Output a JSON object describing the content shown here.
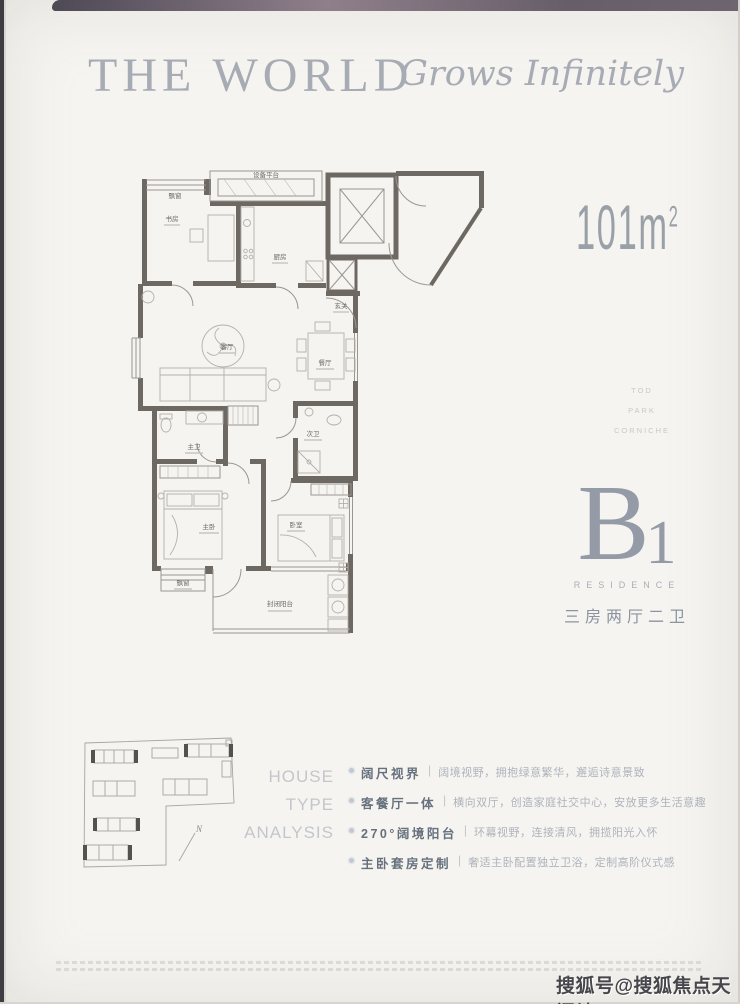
{
  "header": {
    "title_main": "THE WORLD",
    "title_script": "Grows Infinitely"
  },
  "right_panel": {
    "area_value": "101m",
    "area_sup": "2",
    "keywords": [
      "TOD",
      "PARK",
      "CORNICHE"
    ],
    "unit_letter": "B",
    "unit_number": "1",
    "residence_label": "RESIDENCE",
    "unit_type": "三房两厅二卫"
  },
  "floorplan": {
    "rooms": {
      "equipment": "设备平台",
      "bay_top": "飘窗",
      "study": "书房",
      "kitchen": "厨房",
      "foyer": "玄关",
      "dining": "餐厅",
      "living": "客厅",
      "master_bath": "主卫",
      "second_bath": "次卫",
      "master_bedroom": "主卧",
      "bedroom": "卧室",
      "bay_bottom": "飘窗",
      "balcony": "封闭阳台"
    }
  },
  "keyplan": {
    "north_label": "N"
  },
  "analysis": {
    "heading_lines": [
      "HOUSE",
      "TYPE",
      "ANALYSIS"
    ],
    "divider": "|",
    "items": [
      {
        "feature": "阔尺视界",
        "desc": "阔境视野，拥抱绿意繁华，邂逅诗意景致"
      },
      {
        "feature": "客餐厅一体",
        "desc": "横向双厅，创造家庭社交中心，安放更多生活意趣"
      },
      {
        "feature": "270°阔境阳台",
        "desc": "环幕视野，连接清风，拥揽阳光入怀"
      },
      {
        "feature": "主卧套房定制",
        "desc": "奢适主卧配置独立卫浴，定制高阶仪式感"
      }
    ]
  },
  "footer": {
    "watermark": "搜狐号@搜狐焦点天门站"
  },
  "colors": {
    "wall": "#6e6862",
    "title_gray": "#a7abb4",
    "feature_text": "#67707e",
    "watermark_text": "#46464b"
  }
}
